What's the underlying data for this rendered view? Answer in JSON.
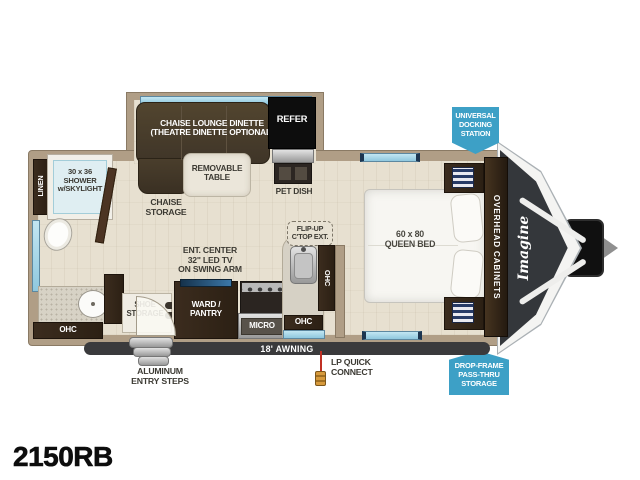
{
  "title": {
    "model": "2150RB"
  },
  "colors": {
    "badge_blue": "#3da0c6",
    "wall_tan": "#b09e86",
    "floor_cream": "#e7e0d0",
    "cabinet_brown": "#33251a",
    "couch_brown": "#463a2c",
    "window_blue": "#a8d8ea",
    "awning_gray": "#3a3a3c"
  },
  "badges": {
    "docking": "UNIVERSAL\nDOCKING\nSTATION",
    "dropframe": "DROP-FRAME\nPASS-THRU\nSTORAGE"
  },
  "labels": {
    "dinette": "CHAISE LOUNGE DINETTE\n(THEATRE DINETTE OPTIONAL)",
    "refer": "REFER",
    "removable_table": "REMOVABLE\nTABLE",
    "pet_dish": "PET DISH",
    "chaise_storage": "CHAISE\nSTORAGE",
    "shower": "30 x 36\nSHOWER\nw/SKYLIGHT",
    "linen": "LINEN",
    "bath_ohc": "OHC",
    "ent_center": "ENT. CENTER\n32\" LED TV\nON SWING ARM",
    "shoe_storage": "SHOE\nSTORAGE",
    "ward_pantry": "WARD /\nPANTRY",
    "micro": "MICRO",
    "flip_up": "FLIP-UP\nC'TOP EXT.",
    "kitchen_ohc_vertical": "OHC",
    "kitchen_ohc": "OHC",
    "queen_bed": "60 x 80\nQUEEN BED",
    "overhead_cabinets": "OVERHEAD CABINETS",
    "brand_logo": "Imagine",
    "awning": "18' AWNING",
    "entry_steps": "ALUMINUM\nENTRY STEPS",
    "lp_quick_connect": "LP QUICK\nCONNECT"
  }
}
